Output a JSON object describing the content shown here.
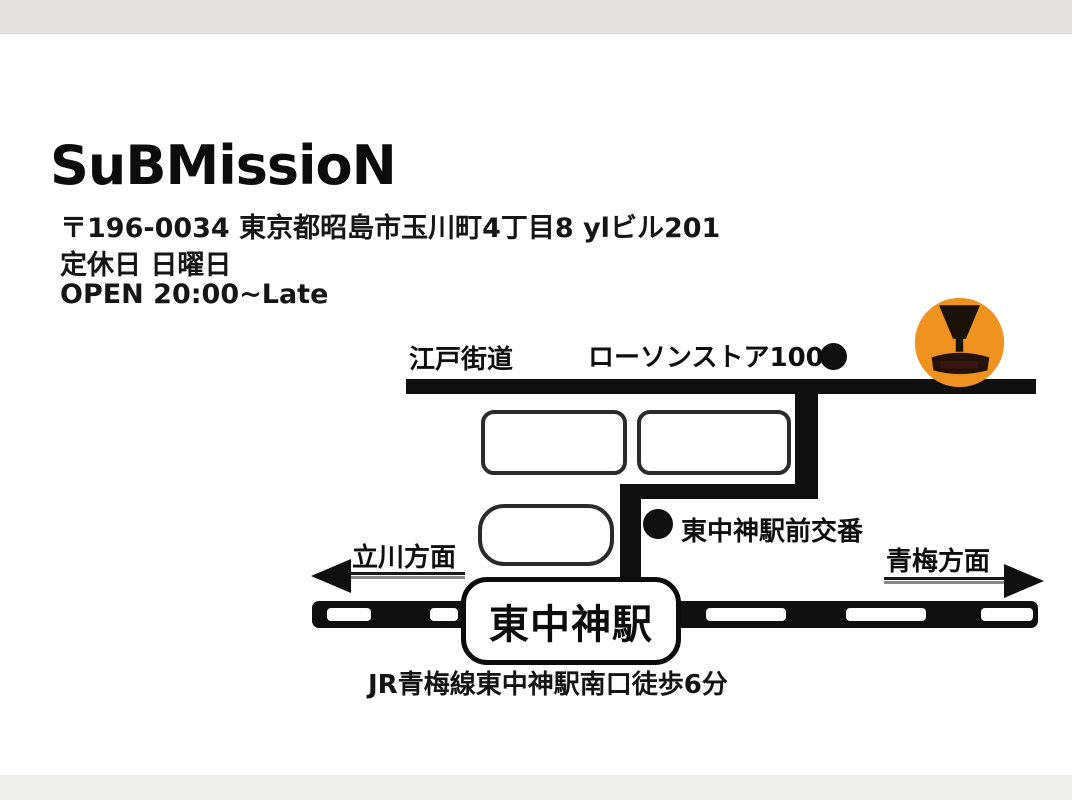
{
  "card": {
    "title": "SuBMissioN",
    "address": "〒196-0034 東京都昭島市玉川町4丁目8 ylビル201",
    "holiday": "定休日 日曜日",
    "hours": "OPEN 20:00~Late"
  },
  "map": {
    "road_name": "江戸街道",
    "landmark_store": "ローソンストア100",
    "police_box": "東中神駅前交番",
    "direction_left": "立川方面",
    "direction_right": "青梅方面",
    "station": "東中神駅",
    "access": "JR青梅線東中神駅南口徒歩6分"
  },
  "icons": {
    "venue_logo": "goblet-icon",
    "store_marker": "filled-circle",
    "police_marker": "filled-circle"
  },
  "colors": {
    "road": "#0f0f0f",
    "logo_orange": "#ef9220",
    "top_band": "#e3e2e0",
    "bottom_band": "#efefee"
  }
}
